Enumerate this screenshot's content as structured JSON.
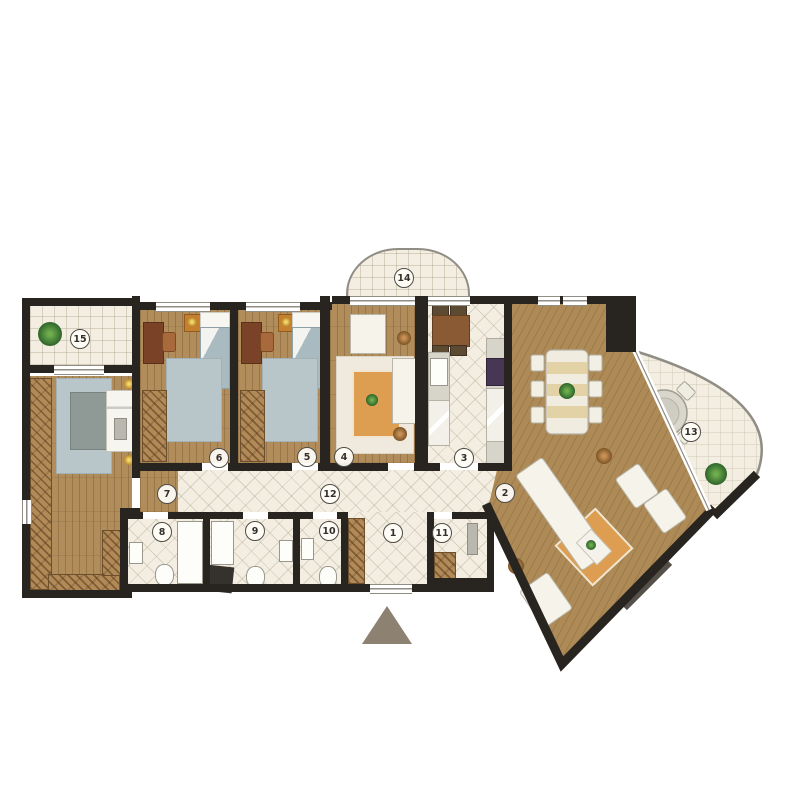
{
  "plan": {
    "title": "apartment-floor-plan",
    "rooms": [
      {
        "label": "1"
      },
      {
        "label": "2"
      },
      {
        "label": "3"
      },
      {
        "label": "4"
      },
      {
        "label": "5"
      },
      {
        "label": "6"
      },
      {
        "label": "7"
      },
      {
        "label": "8"
      },
      {
        "label": "9"
      },
      {
        "label": "10"
      },
      {
        "label": "11"
      },
      {
        "label": "12"
      },
      {
        "label": "13"
      },
      {
        "label": "14"
      },
      {
        "label": "15"
      }
    ],
    "palette": {
      "wall": "#282420",
      "wood_floor": "#b08d5b",
      "tile_floor": "#f3eee1",
      "rug_blue": "#b9c6c9",
      "rug_orange": "#dd9e51",
      "furniture_white": "#f5f3ea",
      "wardrobe": "#b28a57",
      "greenery": "#3f7d35",
      "entrance_arrow": "#8d8172"
    }
  }
}
